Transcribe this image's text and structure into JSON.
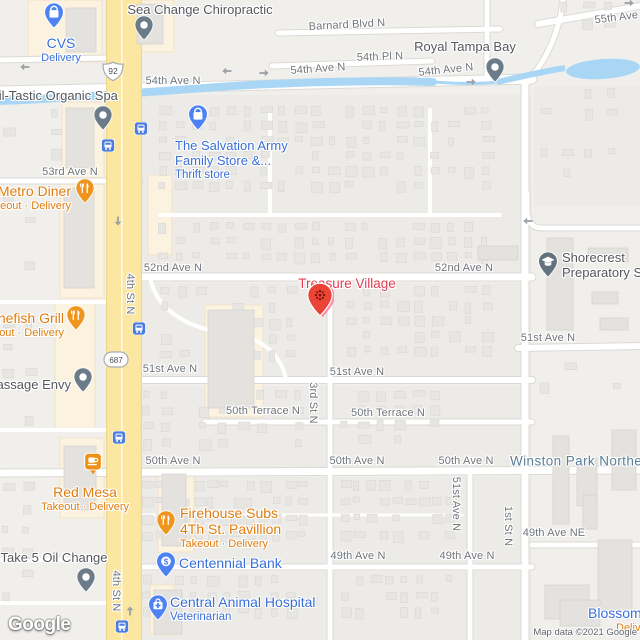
{
  "map": {
    "logo": "Google",
    "attribution": "Map data ©2021 Google",
    "colors": {
      "water": "#a9d6f5",
      "road_primary_yellow": "#fbe7a1",
      "poi_blue": "#3a6fd8",
      "poi_orange": "#e07c0e",
      "poi_gray": "#54585d",
      "street_label_gray": "#70757a",
      "neighborhood_blue": "#5b7e99",
      "destination_pin_red": "#e94436",
      "destination_label_red": "#e23d52",
      "pin_gray": "#6b7b87",
      "pin_blue": "#4d82f3",
      "pin_orange": "#ef941c",
      "transit_blue": "#4d7de0"
    },
    "streets": [
      {
        "t": "Barnard Blvd N",
        "x": 347,
        "y": 25,
        "r": -3
      },
      {
        "t": "54th Pl N",
        "x": 380,
        "y": 57,
        "r": -2
      },
      {
        "t": "54th Ave N",
        "x": 173,
        "y": 81
      },
      {
        "t": "54th Ave N",
        "x": 318,
        "y": 69,
        "r": -4
      },
      {
        "t": "54th Ave N",
        "x": 446,
        "y": 70,
        "r": -6
      },
      {
        "t": "55th Ave N",
        "x": 622,
        "y": 17,
        "r": -7
      },
      {
        "t": "53rd Ave N",
        "x": 70,
        "y": 172
      },
      {
        "t": "52nd Ave N",
        "x": 173,
        "y": 268
      },
      {
        "t": "52nd Ave N",
        "x": 464,
        "y": 268
      },
      {
        "t": "51st Ave N",
        "x": 170,
        "y": 369
      },
      {
        "t": "51st Ave N",
        "x": 357,
        "y": 372
      },
      {
        "t": "51st Ave N",
        "x": 548,
        "y": 338
      },
      {
        "t": "50th Terrace N",
        "x": 263,
        "y": 411
      },
      {
        "t": "50th Terrace N",
        "x": 388,
        "y": 413
      },
      {
        "t": "50th Ave N",
        "x": 173,
        "y": 461
      },
      {
        "t": "50th Ave N",
        "x": 357,
        "y": 461
      },
      {
        "t": "50th Ave N",
        "x": 466,
        "y": 461
      },
      {
        "t": "49th Ave N",
        "x": 358,
        "y": 556
      },
      {
        "t": "49th Ave N",
        "x": 467,
        "y": 556
      },
      {
        "t": "49th Ave NE",
        "x": 554,
        "y": 533
      },
      {
        "t": "4th St N",
        "x": 130,
        "y": 294,
        "r": 90
      },
      {
        "t": "4th St N",
        "x": 116,
        "y": 591,
        "r": 90
      },
      {
        "t": "3rd St N",
        "x": 313,
        "y": 403,
        "r": 90
      },
      {
        "t": "51st Ave N",
        "x": 456,
        "y": 504,
        "r": 90
      },
      {
        "t": "1st St N",
        "x": 508,
        "y": 526,
        "r": 90
      },
      {
        "t": "Winston Park Northeast",
        "x": 510,
        "y": 461,
        "cls": "nbh",
        "a": "l"
      }
    ],
    "shields": [
      {
        "id": "us-92",
        "kind": "us",
        "text": "92",
        "x": 113,
        "y": 74
      },
      {
        "id": "fl-687",
        "kind": "fl",
        "text": "687",
        "x": 116,
        "y": 362
      }
    ],
    "places": [
      {
        "id": "sea-change-chiropractic",
        "pin": {
          "type": "generic",
          "x": 144,
          "y": 46
        },
        "label": {
          "x": 200,
          "y": 3,
          "a": "c",
          "lines": [
            {
              "t": "Sea Change Chiropractic",
              "cls": "g lg"
            }
          ]
        }
      },
      {
        "id": "cvs",
        "pin": {
          "type": "shopping",
          "x": 54,
          "y": 34
        },
        "label": {
          "x": 61,
          "y": 36,
          "a": "c",
          "lines": [
            {
              "t": "CVS",
              "cls": "b xl"
            },
            {
              "t": "Delivery",
              "cls": "b sm"
            }
          ]
        }
      },
      {
        "id": "nail-tastic-organic-spa",
        "pin": {
          "type": "generic",
          "x": 103,
          "y": 136
        },
        "label": {
          "x": 50,
          "y": 89,
          "a": "c",
          "lines": [
            {
              "t": "Nail-Tastic Organic Spa",
              "cls": "g lg"
            }
          ]
        }
      },
      {
        "id": "salvation-army-family-store",
        "pin": {
          "type": "shopping",
          "x": 198,
          "y": 136
        },
        "label": {
          "x": 175,
          "y": 139,
          "a": "l",
          "lines": [
            {
              "t": "The Salvation Army",
              "cls": "b lg"
            },
            {
              "t": "Family Store &...",
              "cls": "b lg"
            },
            {
              "t": "Thrift store",
              "cls": "b sm2"
            }
          ]
        }
      },
      {
        "id": "metro-diner",
        "pin": {
          "type": "food",
          "x": 85,
          "y": 209
        },
        "label": {
          "x": 71,
          "y": 184,
          "a": "r",
          "lines": [
            {
              "t": "Metro Diner",
              "cls": "o xl"
            },
            {
              "t": "Takeout · Delivery",
              "cls": "o sm"
            }
          ]
        }
      },
      {
        "id": "bonefish-grill",
        "pin": {
          "type": "food",
          "x": 76,
          "y": 336
        },
        "label": {
          "x": 64,
          "y": 311,
          "a": "r",
          "lines": [
            {
              "t": "Bonefish Grill",
              "cls": "o xl"
            },
            {
              "t": "Takeout · Delivery",
              "cls": "o sm"
            }
          ]
        }
      },
      {
        "id": "massage-envy",
        "pin": {
          "type": "generic",
          "x": 83,
          "y": 398
        },
        "label": {
          "x": 71,
          "y": 378,
          "a": "r",
          "lines": [
            {
              "t": "Massage Envy",
              "cls": "g lg"
            }
          ]
        }
      },
      {
        "id": "treasure-village",
        "pin": {
          "type": "destination",
          "x": 320,
          "y": 323
        },
        "label": {
          "x": 347,
          "y": 276,
          "a": "c",
          "lines": [
            {
              "t": "Treasure Village",
              "cls": "d"
            }
          ]
        }
      },
      {
        "id": "shorecrest-preparatory-school",
        "pin": {
          "type": "school",
          "x": 548,
          "y": 283
        },
        "label": {
          "x": 562,
          "y": 251,
          "a": "l",
          "lines": [
            {
              "t": "Shorecrest",
              "cls": "g lg"
            },
            {
              "t": "Preparatory School",
              "cls": "g lg"
            }
          ]
        }
      },
      {
        "id": "royal-tampa-bay",
        "pin": {
          "type": "generic",
          "x": 495,
          "y": 88
        },
        "label": {
          "x": 465,
          "y": 40,
          "a": "c",
          "lines": [
            {
              "t": "Royal Tampa Bay",
              "cls": "g lg"
            }
          ]
        }
      },
      {
        "id": "red-mesa",
        "pin": {
          "type": "cafe",
          "x": 93,
          "y": 478
        },
        "label": {
          "x": 85,
          "y": 485,
          "a": "c",
          "lines": [
            {
              "t": "Red Mesa",
              "cls": "o xl"
            },
            {
              "t": "Takeout · Delivery",
              "cls": "o sm"
            }
          ]
        }
      },
      {
        "id": "take-5-oil-change",
        "pin": {
          "type": "generic",
          "x": 86,
          "y": 598
        },
        "label": {
          "x": 54,
          "y": 551,
          "a": "c",
          "lines": [
            {
              "t": "Take 5 Oil Change",
              "cls": "g lg"
            }
          ]
        }
      },
      {
        "id": "firehouse-subs-4th-st-pavillion",
        "pin": {
          "type": "food",
          "x": 166,
          "y": 541
        },
        "label": {
          "x": 180,
          "y": 506,
          "a": "l",
          "lines": [
            {
              "t": "Firehouse Subs",
              "cls": "o xl"
            },
            {
              "t": "4Th St. Pavillion",
              "cls": "o xl"
            },
            {
              "t": "Takeout · Delivery",
              "cls": "o sm"
            }
          ]
        }
      },
      {
        "id": "centennial-bank",
        "pin": {
          "type": "bank",
          "x": 166,
          "y": 583
        },
        "label": {
          "x": 179,
          "y": 556,
          "a": "l",
          "lines": [
            {
              "t": "Centennial Bank",
              "cls": "b xl"
            }
          ]
        }
      },
      {
        "id": "central-animal-hospital",
        "pin": {
          "type": "vet",
          "x": 158,
          "y": 626
        },
        "label": {
          "x": 170,
          "y": 595,
          "a": "l",
          "lines": [
            {
              "t": "Central Animal Hospital",
              "cls": "b xl"
            },
            {
              "t": "Veterinarian",
              "cls": "b sm2"
            }
          ]
        }
      },
      {
        "id": "blossom",
        "label": {
          "x": 588,
          "y": 606,
          "a": "l",
          "lines": [
            {
              "t": "Blossom",
              "cls": "b xl"
            },
            {
              "t": "Delivery",
              "cls": "o sm ind"
            }
          ]
        }
      }
    ],
    "transit_stops": [
      {
        "x": 141,
        "y": 131
      },
      {
        "x": 108,
        "y": 148
      },
      {
        "x": 139,
        "y": 331
      },
      {
        "x": 119,
        "y": 440
      },
      {
        "x": 122,
        "y": 629
      }
    ],
    "arrows": [
      {
        "x": 25,
        "y": 66,
        "d": "left"
      },
      {
        "x": 227,
        "y": 70,
        "d": "left"
      },
      {
        "x": 264,
        "y": 74,
        "d": "right"
      },
      {
        "x": 471,
        "y": 83,
        "d": "right"
      },
      {
        "x": 117,
        "y": 221,
        "d": "down"
      },
      {
        "x": 131,
        "y": 611,
        "d": "up"
      },
      {
        "x": 528,
        "y": 220,
        "d": "left"
      },
      {
        "x": 629,
        "y": 4,
        "d": "right"
      }
    ]
  }
}
